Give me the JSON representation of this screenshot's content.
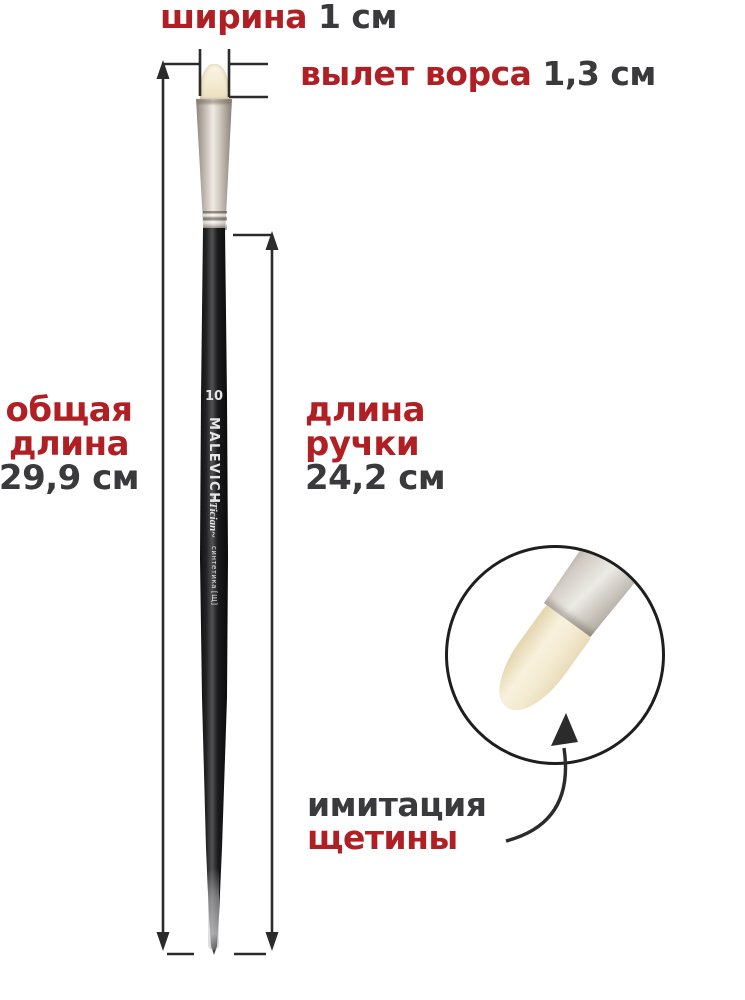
{
  "colors": {
    "accent_red": "#b01f24",
    "text_dark": "#3a3a3c",
    "line": "#2b2b2b",
    "bristle": "#f2e7cc",
    "ferrule": "#c1b9af",
    "handle": "#141416",
    "handle_text": "#e6e6e6",
    "background": "#ffffff"
  },
  "dimensions": {
    "width": {
      "label": "ширина",
      "value": "1 см"
    },
    "bristle_out": {
      "label": "вылет ворса",
      "value": "1,3 см"
    },
    "total_length": {
      "label_line1": "общая",
      "label_line2": "длина",
      "value": "29,9 см"
    },
    "handle_length": {
      "label_line1": "длина",
      "label_line2": "ручки",
      "value": "24,2 см"
    }
  },
  "callout": {
    "line1": "имитация",
    "line2": "щетины"
  },
  "brush": {
    "size_number": "10",
    "brand": "MALEVICH",
    "series": "~Tician~",
    "material": "синтетика",
    "material_code": "[Щ]"
  }
}
